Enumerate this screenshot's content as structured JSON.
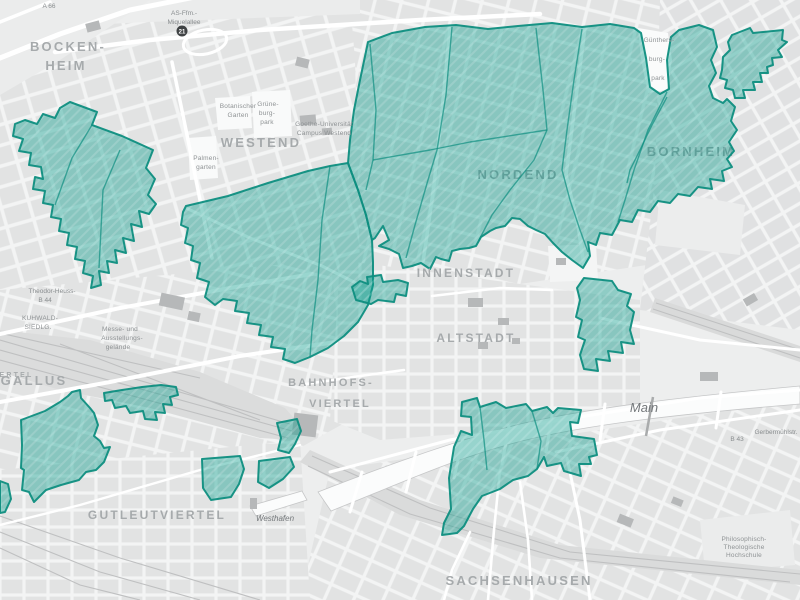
{
  "map": {
    "zones_color": "#0b9d8c",
    "zone_border_color": "#0e8e80",
    "district_labels": [
      {
        "text": "BOCKEN-",
        "x": 68,
        "y": 51,
        "size": 13
      },
      {
        "text": "HEIM",
        "x": 66,
        "y": 70,
        "size": 13
      },
      {
        "text": "WESTEND",
        "x": 261,
        "y": 147,
        "size": 13
      },
      {
        "text": "NORDEND",
        "x": 518,
        "y": 179,
        "size": 13,
        "under": true
      },
      {
        "text": "BORNHEIM",
        "x": 691,
        "y": 156,
        "size": 13,
        "under": true
      },
      {
        "text": "INNENSTADT",
        "x": 466,
        "y": 277,
        "size": 12
      },
      {
        "text": "ALTSTADT",
        "x": 476,
        "y": 342,
        "size": 12
      },
      {
        "text": "GALLUS",
        "x": 34,
        "y": 385,
        "size": 13
      },
      {
        "text": "BAHNHOFS-",
        "x": 331,
        "y": 386,
        "size": 11
      },
      {
        "text": "VIERTEL",
        "x": 340,
        "y": 407,
        "size": 11
      },
      {
        "text": "GUTLEUTVIERTEL",
        "x": 157,
        "y": 519,
        "size": 12
      },
      {
        "text": "SACHSENHAUSEN",
        "x": 519,
        "y": 585,
        "size": 13
      },
      {
        "text": "VIERTEL",
        "x": 11,
        "y": 377,
        "size": 7
      }
    ],
    "water_labels": [
      {
        "text": "Main",
        "x": 644,
        "y": 412,
        "size": 13
      },
      {
        "text": "Westhafen",
        "x": 275,
        "y": 521,
        "size": 8
      }
    ],
    "road_labels": [
      {
        "text": "A 66",
        "x": 49,
        "y": 8
      },
      {
        "text": "AS-Ffm.-",
        "x": 184,
        "y": 15
      },
      {
        "text": "Miquelallee",
        "x": 184,
        "y": 24
      },
      {
        "text": "Theodor-Heuss-",
        "x": 52,
        "y": 293
      },
      {
        "text": "B 44",
        "x": 45,
        "y": 302
      },
      {
        "text": "B 43",
        "x": 737,
        "y": 441
      },
      {
        "text": "Gerbermühlstr.",
        "x": 776,
        "y": 434
      }
    ],
    "area_labels": [
      {
        "text": "Botanischer",
        "x": 238,
        "y": 108
      },
      {
        "text": "Garten",
        "x": 238,
        "y": 117
      },
      {
        "text": "Grüne-",
        "x": 268,
        "y": 106
      },
      {
        "text": "burg-",
        "x": 267,
        "y": 115
      },
      {
        "text": "park",
        "x": 267,
        "y": 124
      },
      {
        "text": "Palmen-",
        "x": 206,
        "y": 160
      },
      {
        "text": "garten",
        "x": 206,
        "y": 169
      },
      {
        "text": "Goethe-Universität",
        "x": 324,
        "y": 126
      },
      {
        "text": "Campus Westend",
        "x": 324,
        "y": 135
      },
      {
        "text": "Günthers-",
        "x": 659,
        "y": 42
      },
      {
        "text": "burg-",
        "x": 657,
        "y": 61
      },
      {
        "text": "park",
        "x": 658,
        "y": 80
      },
      {
        "text": "Messe- und",
        "x": 120,
        "y": 331
      },
      {
        "text": "Ausstellungs-",
        "x": 122,
        "y": 340
      },
      {
        "text": "gelände",
        "x": 118,
        "y": 349
      },
      {
        "text": "KUHWALD-",
        "x": 40,
        "y": 320
      },
      {
        "text": "SIEDLG.",
        "x": 38,
        "y": 329
      },
      {
        "text": "Philosophisch-",
        "x": 744,
        "y": 541
      },
      {
        "text": "Theologische",
        "x": 744,
        "y": 549
      },
      {
        "text": "Hochschule",
        "x": 744,
        "y": 557
      }
    ],
    "junction_badge": {
      "text": "21",
      "x": 182,
      "y": 31
    }
  }
}
